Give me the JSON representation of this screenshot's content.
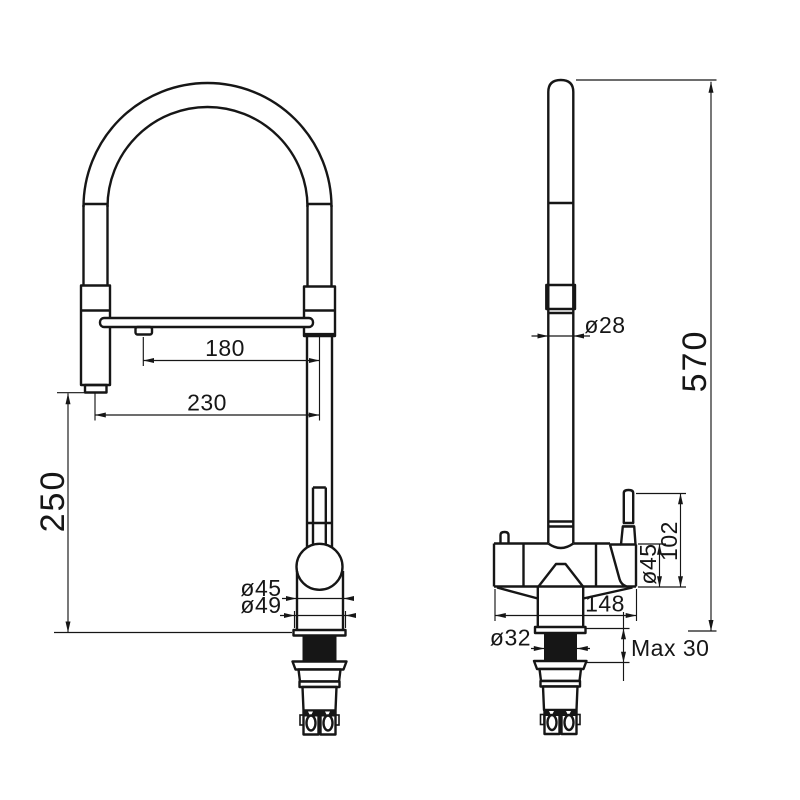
{
  "drawing": {
    "kind": "faucet technical drawing, two orthographic views, dimensions in mm",
    "colors": {
      "background": "#ffffff",
      "line": "#161616"
    },
    "front_view": {
      "name": "front view",
      "dims": {
        "spout_reach": "180",
        "outlet_reach": "230",
        "outlet_height": "250",
        "body_diameter": "ø45",
        "base_diameter": "ø49"
      }
    },
    "side_view": {
      "name": "side view",
      "dims": {
        "tube_diameter": "ø28",
        "total_height": "570",
        "handle_height": "102",
        "body_diameter": "ø45",
        "body_depth": "148",
        "hole_diameter": "ø32",
        "deck_thickness": "Max 30"
      }
    }
  }
}
